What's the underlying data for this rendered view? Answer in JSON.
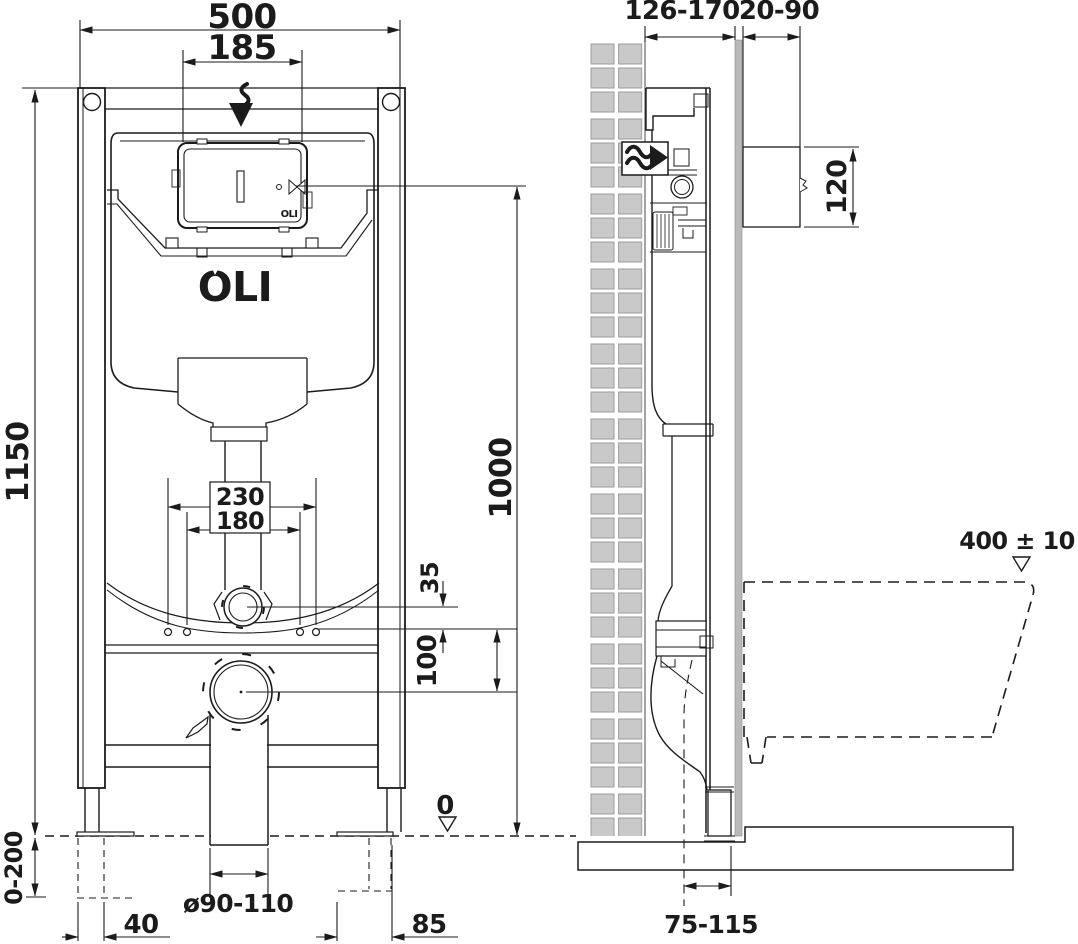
{
  "colors": {
    "line": "#1b1b1b",
    "tile_fill": "#c9c9c9",
    "tile_edge": "#9b9b9b",
    "wall_board": "#b9b9b9",
    "background": "#ffffff"
  },
  "front_view": {
    "logo_main": "OLI",
    "logo_plate": "OLI",
    "dims": {
      "frame_width": "500",
      "plate_width": "185",
      "frame_height": "1150",
      "bolt_spacing_outer": "230",
      "bolt_spacing_inner": "180",
      "inlet_offset": "35",
      "inlet_to_drain": "100",
      "plate_axis_height": "1000",
      "leg_adjust_range": "0-200",
      "foot_left": "40",
      "drain_pipe_diameter": "ø90-110",
      "foot_right": "85",
      "floor_level": "0"
    }
  },
  "side_view": {
    "dims": {
      "install_depth": "126-170",
      "plate_depth": "20-90",
      "plate_height": "120",
      "bowl_top_height": "400 ± 10",
      "drain_wall_distance": "75-115"
    }
  }
}
